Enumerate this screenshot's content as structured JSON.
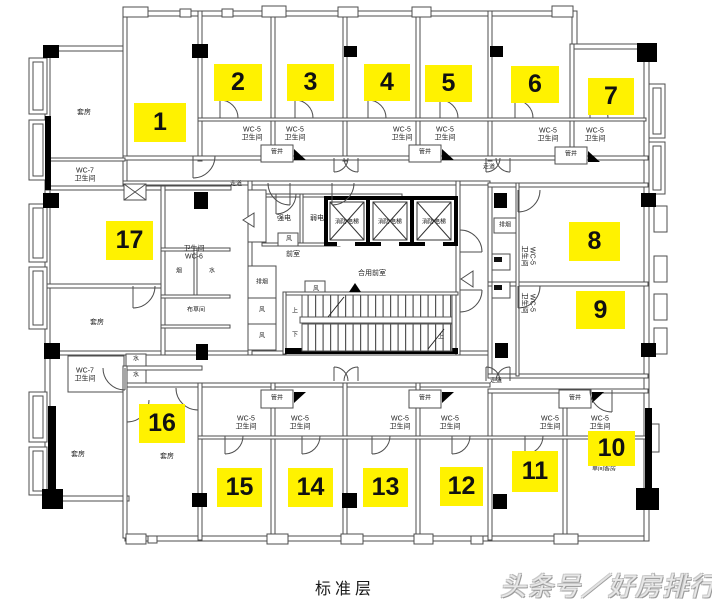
{
  "title": "标准层",
  "watermark": "头条号／好房排行",
  "units": [
    "1",
    "2",
    "3",
    "4",
    "5",
    "6",
    "7",
    "8",
    "9",
    "10",
    "11",
    "12",
    "13",
    "14",
    "15",
    "16",
    "17"
  ],
  "labels": {
    "suite": "套房",
    "wc5": "WC-5",
    "wc6": "WC-6",
    "wc7": "WC-7",
    "bathroom": "卫生间",
    "pipe_shaft": "管井",
    "corridor": "走道",
    "strong_power": "强电",
    "weak_power": "弱电",
    "fire_elevator": "消防电梯",
    "anteroom": "前室",
    "shared_anteroom": "合用前室",
    "vent": "风",
    "smoke_extract": "排烟",
    "smoke": "烟",
    "water": "水",
    "linen_room": "布草间",
    "single_room": "单间客房",
    "up": "上",
    "down": "下"
  }
}
